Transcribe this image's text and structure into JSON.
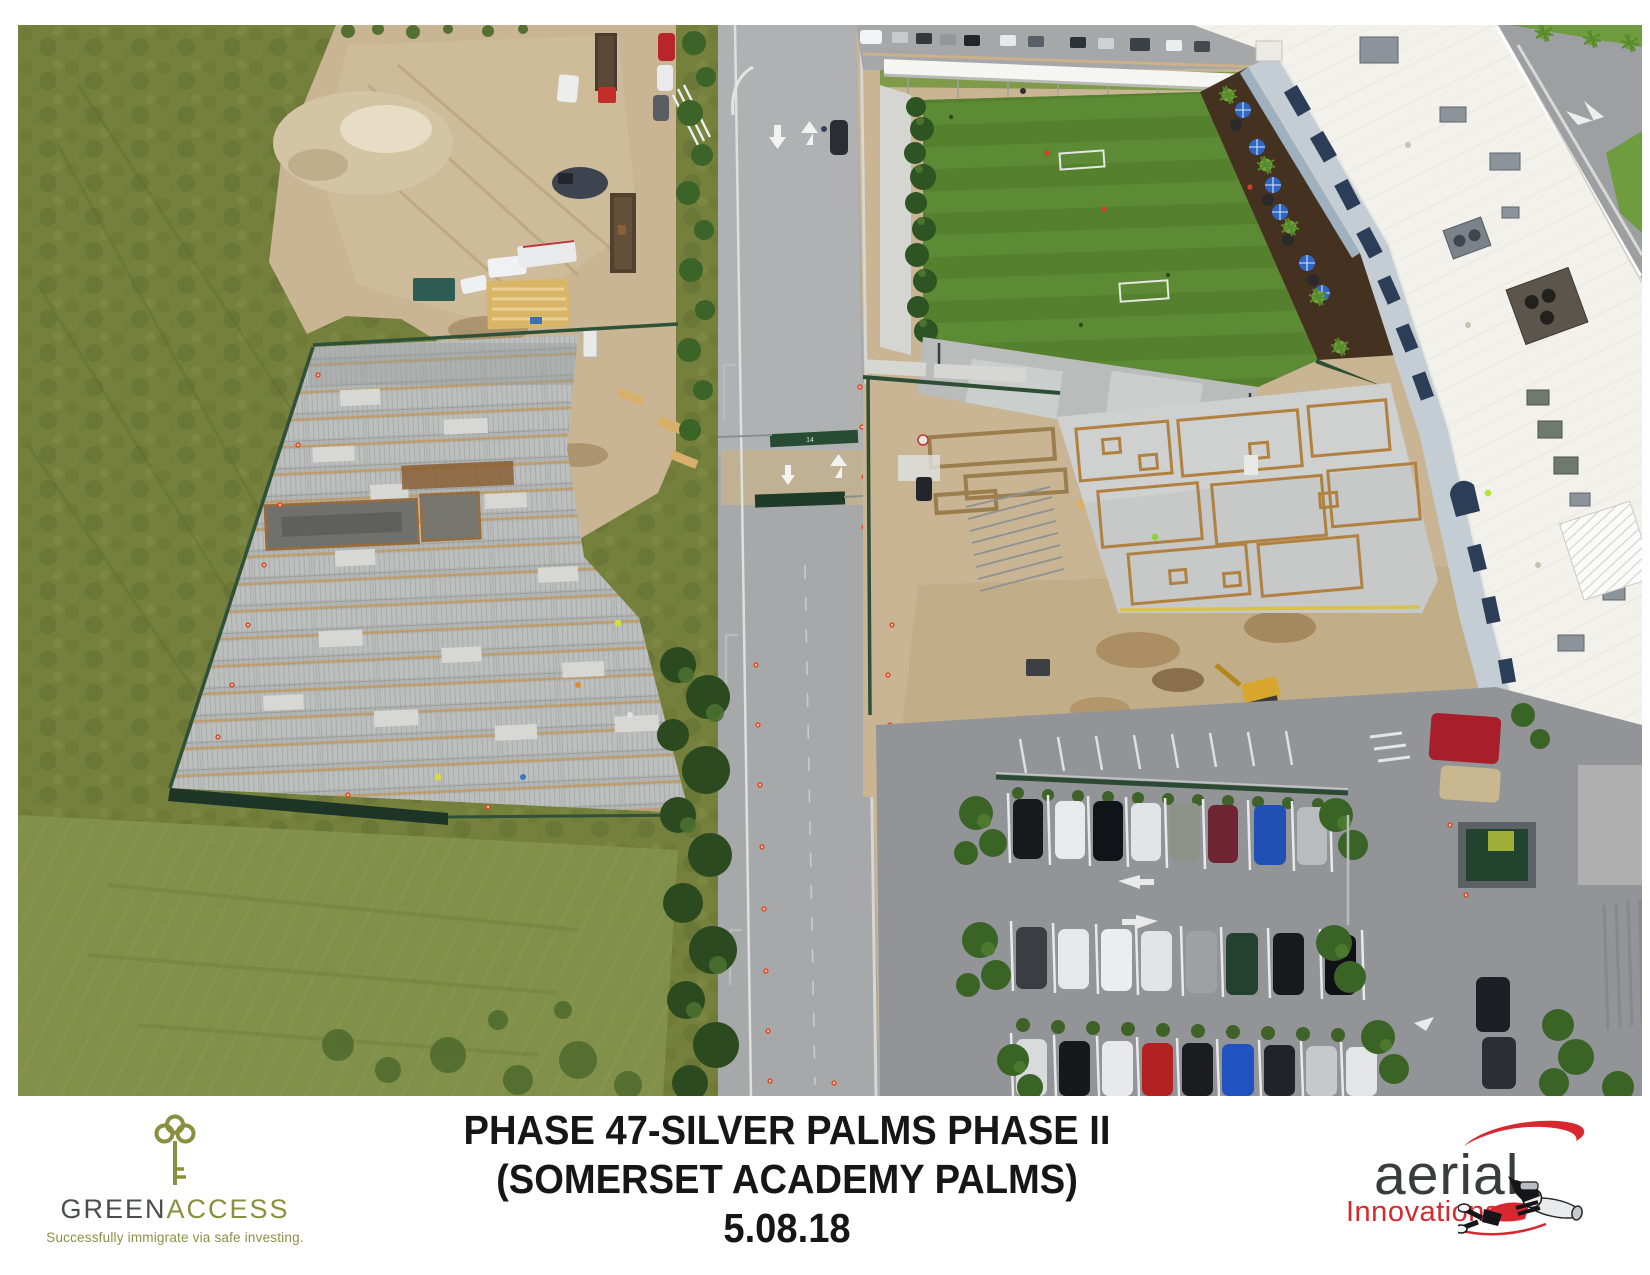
{
  "page": {
    "background": "#ffffff"
  },
  "photo": {
    "description": "Aerial view of construction site: concrete foundation slabs with wood formwork, access road, artificial turf field, white school building roof and parking lot",
    "gate_label": "14",
    "colors": {
      "grass": "#74803c",
      "turf": "#57812f",
      "dirt": "#c9b593",
      "roof_white": "#f2f1ec",
      "road": "#a7a8aa",
      "fence_green": "#2d4f36",
      "formwork_tan": "#b1813f"
    }
  },
  "footer": {
    "title": {
      "line1": "PHASE 47-SILVER PALMS PHASE II",
      "line2": "(SOMERSET ACADEMY PALMS)",
      "line3": "5.08.18"
    },
    "greenaccess": {
      "brand_part1": "GREEN",
      "brand_part2": "ACCESS",
      "tagline": "Successfully immigrate via safe investing.",
      "color_charcoal": "#4b4c4e",
      "color_olive": "#8a8f3e",
      "icon": "key-icon"
    },
    "aerial_innovations": {
      "brand": "aerial",
      "subbrand": "Innovations",
      "color_red": "#d7282f",
      "color_dark": "#3a3b3d",
      "icons": [
        "propeller-swoosh-icon",
        "flying-photographer-icon"
      ]
    }
  }
}
